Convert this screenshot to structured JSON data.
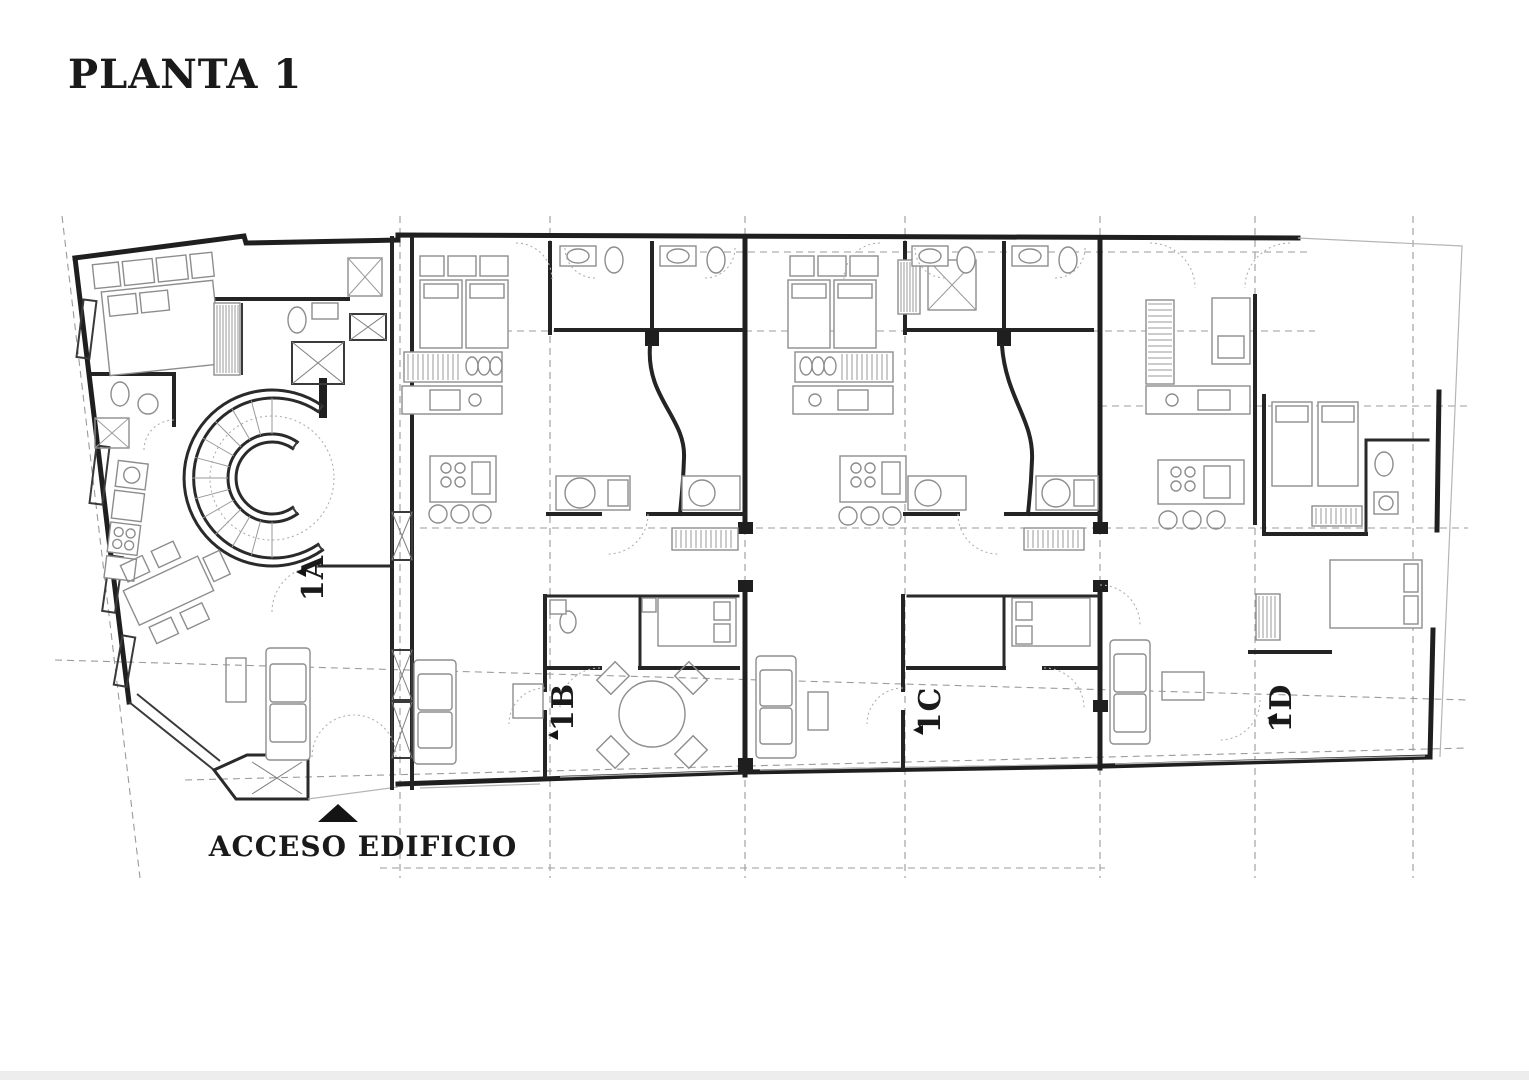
{
  "title": "PLANTA 1",
  "entrance": {
    "label": "ACCESO EDIFICIO",
    "marker": "up-triangle"
  },
  "units": [
    {
      "id": "1A",
      "label": "1A"
    },
    {
      "id": "1B",
      "label": "1B"
    },
    {
      "id": "1C",
      "label": "1C"
    },
    {
      "id": "1D",
      "label": "1D"
    }
  ],
  "drawing": {
    "type": "architectural-floor-plan",
    "floor": "1",
    "units_count": 4,
    "features": [
      "spiral-staircase",
      "elevator-shaft",
      "column-grid-lines",
      "furniture-layout"
    ]
  },
  "colors": {
    "background": "#ffffff",
    "wall": "#1f1f1f",
    "furniture": "#8d8d8d",
    "grid": "#9b9b9b",
    "text": "#1a1a1a",
    "marker": "#141414",
    "faint_strip": "#ededed"
  }
}
